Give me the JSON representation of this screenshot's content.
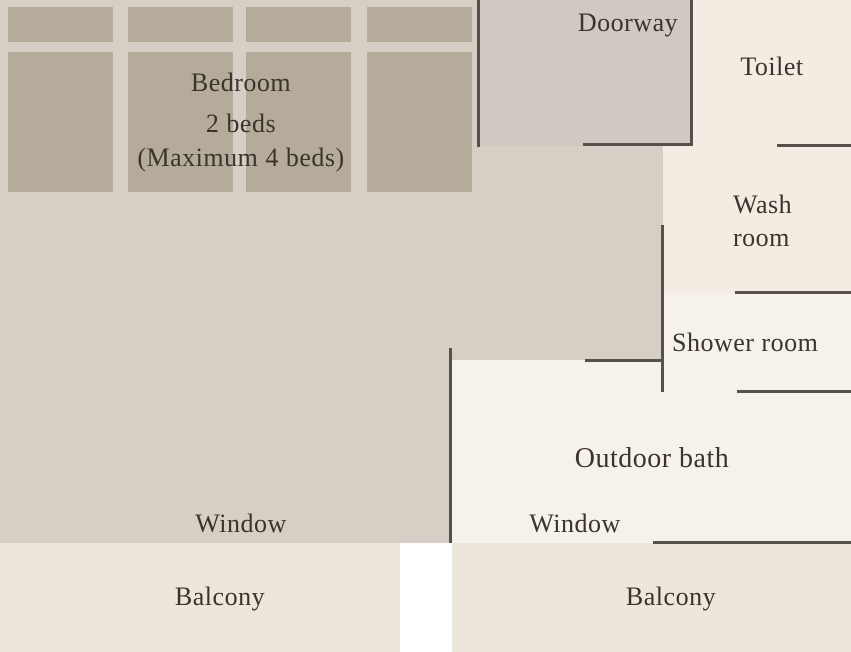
{
  "floorplan": {
    "rooms": {
      "bedroom": {
        "label": "Bedroom",
        "beds": "2 beds",
        "max_beds": "(Maximum 4 beds)"
      },
      "doorway": {
        "label": "Doorway"
      },
      "toilet": {
        "label": "Toilet"
      },
      "washroom": {
        "line1": "Wash",
        "line2": "room"
      },
      "shower": {
        "label": "Shower room"
      },
      "outdoor_bath": {
        "label": "Outdoor bath"
      },
      "window_left": {
        "label": "Window"
      },
      "window_right": {
        "label": "Window"
      },
      "balcony_left": {
        "label": "Balcony"
      },
      "balcony_right": {
        "label": "Balcony"
      }
    },
    "colors": {
      "room": "#d5cfc6",
      "mat": "#b5ab9b",
      "doorway": "#cfc9c2",
      "toilet": "#f2ece3",
      "washroom": "#f2ece3",
      "shower": "#f6f1ea",
      "bath": "#f6f1ea",
      "balcony": "#ede6db",
      "wall": "#56514b",
      "text": "#3a342c"
    }
  }
}
